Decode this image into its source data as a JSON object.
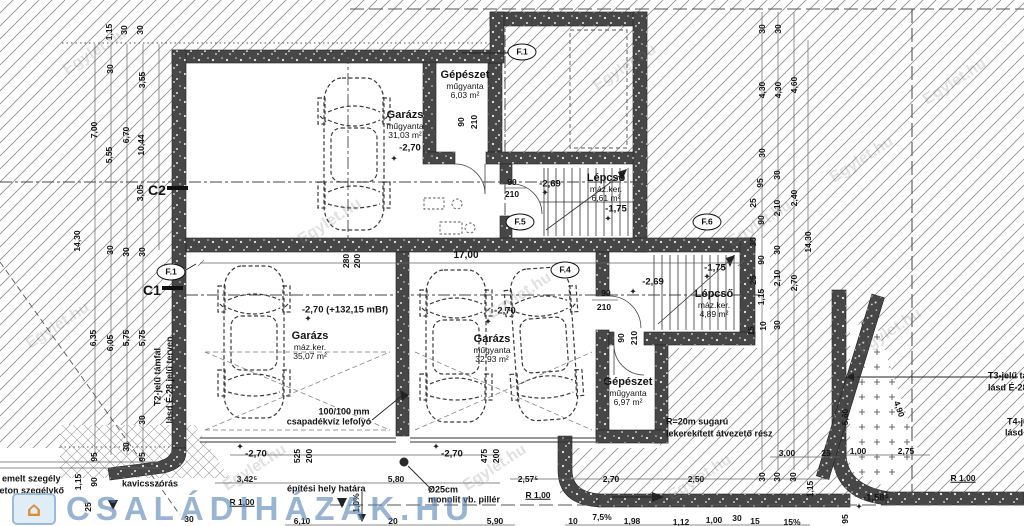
{
  "plan": {
    "rooms": [
      {
        "name": "Garázs",
        "finish": "műgyanta",
        "area": "31,03 m²",
        "x": 405,
        "y": 110
      },
      {
        "name": "Gépészet",
        "finish": "műgyanta",
        "area": "6,03 m²",
        "x": 465,
        "y": 70
      },
      {
        "name": "Lépcső",
        "finish": "máz.ker.",
        "area": "6,61 m²",
        "x": 606,
        "y": 173
      },
      {
        "name": "Garázs",
        "finish": "máz.ker.",
        "area": "35,07 m²",
        "x": 310,
        "y": 331
      },
      {
        "name": "Garázs",
        "finish": "műgyanta",
        "area": "32,93 m²",
        "x": 492,
        "y": 334
      },
      {
        "name": "Lépcső",
        "finish": "máz.ker.",
        "area": "4,89 m²",
        "x": 714,
        "y": 289
      },
      {
        "name": "Gépészet",
        "finish": "műgyanta",
        "area": "6,97 m²",
        "x": 628,
        "y": 377
      }
    ],
    "levels": [
      {
        "t": "-2,70",
        "x": 410,
        "y": 148
      },
      {
        "t": "-2,69",
        "x": 550,
        "y": 184
      },
      {
        "t": "-1,75",
        "x": 616,
        "y": 209
      },
      {
        "t": "-2,70 (+132,15 mBf)",
        "x": 345,
        "y": 310
      },
      {
        "t": "-2,70",
        "x": 505,
        "y": 311
      },
      {
        "t": "-2,69",
        "x": 653,
        "y": 282
      },
      {
        "t": "-1,75",
        "x": 715,
        "y": 268
      },
      {
        "t": "-2,70",
        "x": 256,
        "y": 454
      },
      {
        "t": "-2,70",
        "x": 452,
        "y": 454
      },
      {
        "t": "-1,58⁵",
        "x": 876,
        "y": 498
      }
    ],
    "symbols": {
      "level_marker": "✦",
      "house_icon": "⌂"
    },
    "level_marks": [
      {
        "x": 394,
        "y": 159
      },
      {
        "x": 545,
        "y": 193
      },
      {
        "x": 608,
        "y": 219
      },
      {
        "x": 308,
        "y": 319
      },
      {
        "x": 488,
        "y": 322
      },
      {
        "x": 633,
        "y": 292
      },
      {
        "x": 707,
        "y": 277
      },
      {
        "x": 240,
        "y": 447
      },
      {
        "x": 436,
        "y": 447
      },
      {
        "x": 859,
        "y": 507
      }
    ],
    "markers": [
      {
        "t": "F.1",
        "x": 522,
        "y": 52
      },
      {
        "t": "F.1",
        "x": 171,
        "y": 272
      },
      {
        "t": "F.5",
        "x": 520,
        "y": 222
      },
      {
        "t": "F.4",
        "x": 565,
        "y": 270
      },
      {
        "t": "F.6",
        "x": 707,
        "y": 222
      }
    ],
    "sections": [
      {
        "t": "C2",
        "x": 157,
        "y": 190
      },
      {
        "t": "C1",
        "x": 152,
        "y": 290
      }
    ],
    "dims": [
      {
        "t": "1,15",
        "x": 109,
        "y": 32,
        "r": -90
      },
      {
        "t": "30",
        "x": 124,
        "y": 30,
        "r": -90
      },
      {
        "t": "30",
        "x": 140,
        "y": 30,
        "r": -90
      },
      {
        "t": "30",
        "x": 110,
        "y": 69,
        "r": -90
      },
      {
        "t": "3,55",
        "x": 142,
        "y": 80,
        "r": -90
      },
      {
        "t": "7,00",
        "x": 94,
        "y": 130,
        "r": -90
      },
      {
        "t": "5,55",
        "x": 109,
        "y": 155,
        "r": -90
      },
      {
        "t": "6,70",
        "x": 126,
        "y": 135,
        "r": -90
      },
      {
        "t": "10,44",
        "x": 141,
        "y": 145,
        "r": -90
      },
      {
        "t": "3,05",
        "x": 140,
        "y": 193,
        "r": -90
      },
      {
        "t": "14,30",
        "x": 77,
        "y": 241,
        "r": -90
      },
      {
        "t": "30",
        "x": 110,
        "y": 250,
        "r": -90
      },
      {
        "t": "30",
        "x": 126,
        "y": 252,
        "r": -90
      },
      {
        "t": "30",
        "x": 142,
        "y": 252,
        "r": -90
      },
      {
        "t": "6,35",
        "x": 93,
        "y": 338,
        "r": -90
      },
      {
        "t": "6,05",
        "x": 110,
        "y": 343,
        "r": -90
      },
      {
        "t": "5,75",
        "x": 126,
        "y": 338,
        "r": -90
      },
      {
        "t": "5,75",
        "x": 142,
        "y": 338,
        "r": -90
      },
      {
        "t": "30",
        "x": 142,
        "y": 420,
        "r": -90
      },
      {
        "t": "30",
        "x": 126,
        "y": 447,
        "r": -90
      },
      {
        "t": "95",
        "x": 94,
        "y": 457,
        "r": -90
      },
      {
        "t": "95",
        "x": 142,
        "y": 457,
        "r": -90
      },
      {
        "t": "1,15",
        "x": 78,
        "y": 482,
        "r": -90
      },
      {
        "t": "90",
        "x": 94,
        "y": 482,
        "r": -90
      },
      {
        "t": "25",
        "x": 88,
        "y": 507,
        "r": -90
      },
      {
        "t": "30",
        "x": 762,
        "y": 29,
        "r": -90
      },
      {
        "t": "30",
        "x": 778,
        "y": 29,
        "r": -90
      },
      {
        "t": "4,30",
        "x": 762,
        "y": 90,
        "r": -90
      },
      {
        "t": "4,30",
        "x": 778,
        "y": 90,
        "r": -90
      },
      {
        "t": "4,60",
        "x": 794,
        "y": 85,
        "r": -90
      },
      {
        "t": "30",
        "x": 762,
        "y": 153,
        "r": -90
      },
      {
        "t": "95",
        "x": 760,
        "y": 183,
        "r": -90
      },
      {
        "t": "25",
        "x": 753,
        "y": 203,
        "r": -90
      },
      {
        "t": "90",
        "x": 761,
        "y": 220,
        "r": -90
      },
      {
        "t": "30",
        "x": 753,
        "y": 242,
        "r": -90
      },
      {
        "t": "90",
        "x": 761,
        "y": 260,
        "r": -90
      },
      {
        "t": "25",
        "x": 753,
        "y": 280,
        "r": -90
      },
      {
        "t": "1,15",
        "x": 761,
        "y": 297,
        "r": -90
      },
      {
        "t": "10",
        "x": 763,
        "y": 326,
        "r": -90
      },
      {
        "t": "15",
        "x": 751,
        "y": 331,
        "r": -90
      },
      {
        "t": "30",
        "x": 777,
        "y": 175,
        "r": -90
      },
      {
        "t": "2,10",
        "x": 777,
        "y": 208,
        "r": -90
      },
      {
        "t": "30",
        "x": 777,
        "y": 250,
        "r": -90
      },
      {
        "t": "2,10",
        "x": 777,
        "y": 278,
        "r": -90
      },
      {
        "t": "30",
        "x": 777,
        "y": 325,
        "r": -90
      },
      {
        "t": "2,40",
        "x": 794,
        "y": 198,
        "r": -90
      },
      {
        "t": "2,70",
        "x": 794,
        "y": 283,
        "r": -90
      },
      {
        "t": "14,30",
        "x": 808,
        "y": 242,
        "r": -90
      },
      {
        "t": "90",
        "x": 461,
        "y": 122,
        "r": -90
      },
      {
        "t": "210",
        "x": 474,
        "y": 122,
        "r": -90
      },
      {
        "t": "90",
        "x": 512,
        "y": 182
      },
      {
        "t": "210",
        "x": 512,
        "y": 194
      },
      {
        "t": "90",
        "x": 606,
        "y": 293
      },
      {
        "t": "210",
        "x": 604,
        "y": 307
      },
      {
        "t": "90",
        "x": 621,
        "y": 338,
        "r": -90
      },
      {
        "t": "210",
        "x": 634,
        "y": 338,
        "r": -90
      },
      {
        "t": "280",
        "x": 346,
        "y": 261,
        "r": -90
      },
      {
        "t": "200",
        "x": 357,
        "y": 261,
        "r": -90
      },
      {
        "t": "17,00",
        "x": 466,
        "y": 256,
        "s": 10
      },
      {
        "t": "525",
        "x": 297,
        "y": 456,
        "r": -90
      },
      {
        "t": "200",
        "x": 309,
        "y": 456,
        "r": -90
      },
      {
        "t": "475",
        "x": 484,
        "y": 456,
        "r": -90
      },
      {
        "t": "200",
        "x": 496,
        "y": 456,
        "r": -90
      },
      {
        "t": "3,42⁵",
        "x": 247,
        "y": 479
      },
      {
        "t": "5,80",
        "x": 396,
        "y": 479
      },
      {
        "t": "30",
        "x": 189,
        "y": 519
      },
      {
        "t": "6,10",
        "x": 302,
        "y": 521
      },
      {
        "t": "20",
        "x": 393,
        "y": 521
      },
      {
        "t": "5,90",
        "x": 495,
        "y": 521
      },
      {
        "t": "2,57⁵",
        "x": 528,
        "y": 479
      },
      {
        "t": "2,70",
        "x": 611,
        "y": 479
      },
      {
        "t": "2,50",
        "x": 696,
        "y": 479
      },
      {
        "t": "30",
        "x": 762,
        "y": 477,
        "r": -90
      },
      {
        "t": "30",
        "x": 777,
        "y": 477,
        "r": -90
      },
      {
        "t": "30",
        "x": 793,
        "y": 477,
        "r": -90
      },
      {
        "t": "1,15",
        "x": 810,
        "y": 489,
        "r": -90
      },
      {
        "t": "3,00",
        "x": 787,
        "y": 453
      },
      {
        "t": "25",
        "x": 826,
        "y": 453
      },
      {
        "t": "7,5%",
        "x": 602,
        "y": 517
      },
      {
        "t": "10",
        "x": 573,
        "y": 521
      },
      {
        "t": "1,98",
        "x": 632,
        "y": 521
      },
      {
        "t": "1,12",
        "x": 681,
        "y": 522
      },
      {
        "t": "1,00",
        "x": 714,
        "y": 520
      },
      {
        "t": "30",
        "x": 737,
        "y": 518
      },
      {
        "t": "15",
        "x": 755,
        "y": 521
      },
      {
        "t": "15%",
        "x": 792,
        "y": 522
      },
      {
        "t": "95",
        "x": 845,
        "y": 519,
        "r": -90
      },
      {
        "t": "1,0%",
        "x": 356,
        "y": 503,
        "r": -90
      },
      {
        "t": "1,00",
        "x": 858,
        "y": 451
      },
      {
        "t": "2,75",
        "x": 906,
        "y": 451
      },
      {
        "t": "5,60",
        "x": 845,
        "y": 417,
        "r": -90
      },
      {
        "t": "4,90",
        "x": 899,
        "y": 409,
        "r": 70
      },
      {
        "t": "R 1,00",
        "x": 242,
        "y": 502,
        "u": 1
      },
      {
        "t": "R 1,00",
        "x": 538,
        "y": 495,
        "u": 1
      },
      {
        "t": "R 1,00",
        "x": 963,
        "y": 478,
        "u": 1
      }
    ],
    "notes": [
      {
        "t": "100/100 mm",
        "x": 344,
        "y": 412,
        "b": 1
      },
      {
        "t": "csapadékvíz lefolyó",
        "x": 329,
        "y": 422,
        "b": 1
      },
      {
        "t": "R=20m sugarú",
        "x": 666,
        "y": 422,
        "b": 1,
        "a": "l"
      },
      {
        "t": "lekerekített átvezető rész",
        "x": 666,
        "y": 434,
        "b": 1,
        "a": "l"
      },
      {
        "t": "építési hely határa",
        "x": 287,
        "y": 489,
        "b": 1,
        "a": "l"
      },
      {
        "t": "Ø25cm",
        "x": 428,
        "y": 490,
        "b": 1,
        "a": "l"
      },
      {
        "t": "monolit vb. pillér",
        "x": 428,
        "y": 500,
        "b": 1,
        "a": "l"
      },
      {
        "t": "kavicsszórás",
        "x": 122,
        "y": 484,
        "b": 1,
        "a": "l"
      },
      {
        "t": "emelt szegély",
        "x": 2,
        "y": 479,
        "b": 1,
        "a": "l"
      },
      {
        "t": "beton szegélykő",
        "x": -6,
        "y": 491,
        "b": 1,
        "a": "l"
      },
      {
        "t": "T2-jelű támfal",
        "x": 158,
        "y": 377,
        "r": -90,
        "b": 1
      },
      {
        "t": "lásd É-28 jelű terven",
        "x": 170,
        "y": 380,
        "r": -90,
        "b": 1
      },
      {
        "t": "T3-jelű támfal",
        "x": 988,
        "y": 376,
        "b": 1,
        "a": "l"
      },
      {
        "t": "lásd É-28 jelű terven",
        "x": 988,
        "y": 388,
        "b": 1,
        "a": "l"
      },
      {
        "t": "T4-jelű támfal",
        "x": 1007,
        "y": 422,
        "b": 1,
        "a": "l"
      },
      {
        "t": "lásd É-28",
        "x": 1005,
        "y": 433,
        "b": 1,
        "a": "l"
      }
    ],
    "watermarks": {
      "site": "Egylet.hu",
      "site_positions": [
        {
          "x": 95,
          "y": 52
        },
        {
          "x": 330,
          "y": 222
        },
        {
          "x": 255,
          "y": 468
        },
        {
          "x": 520,
          "y": 296
        },
        {
          "x": 625,
          "y": 68
        },
        {
          "x": 760,
          "y": 224
        },
        {
          "x": 890,
          "y": 332
        },
        {
          "x": 495,
          "y": 468
        },
        {
          "x": 955,
          "y": 82
        },
        {
          "x": 58,
          "y": 326
        },
        {
          "x": 700,
          "y": 478
        },
        {
          "x": 862,
          "y": 160
        }
      ],
      "brand": "CSALÁDIHÁZAK.HU"
    }
  }
}
